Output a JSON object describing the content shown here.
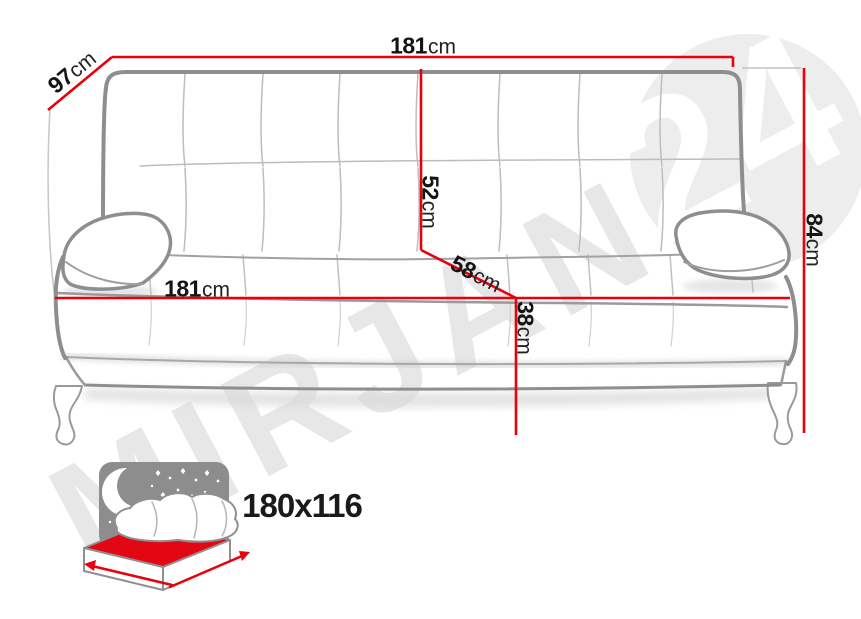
{
  "watermark": {
    "brand": "MIRJAN",
    "badge": "24"
  },
  "dimensions": {
    "total_width": {
      "value": "181",
      "unit": "cm"
    },
    "total_depth": {
      "value": "97",
      "unit": "cm"
    },
    "total_height": {
      "value": "84",
      "unit": "cm"
    },
    "backrest_height": {
      "value": "52",
      "unit": "cm"
    },
    "seat_depth": {
      "value": "58",
      "unit": "cm"
    },
    "seat_width": {
      "value": "181",
      "unit": "cm"
    },
    "seat_height": {
      "value": "38",
      "unit": "cm"
    }
  },
  "sleeping_area": {
    "size": "180x116"
  },
  "icons": {
    "sleeping_function": "bed-with-night-sky-icon"
  },
  "colors": {
    "dimension_line": "#e8000d",
    "sofa_outline": "#8e8e8e",
    "watermark_gray": "#e7e7e7",
    "badge_circle": "#ededed",
    "badge_text": "#ffffff",
    "icon_night_sky": "#8d8d8d",
    "icon_mattress": "#e30613",
    "label_text": "#141414"
  }
}
